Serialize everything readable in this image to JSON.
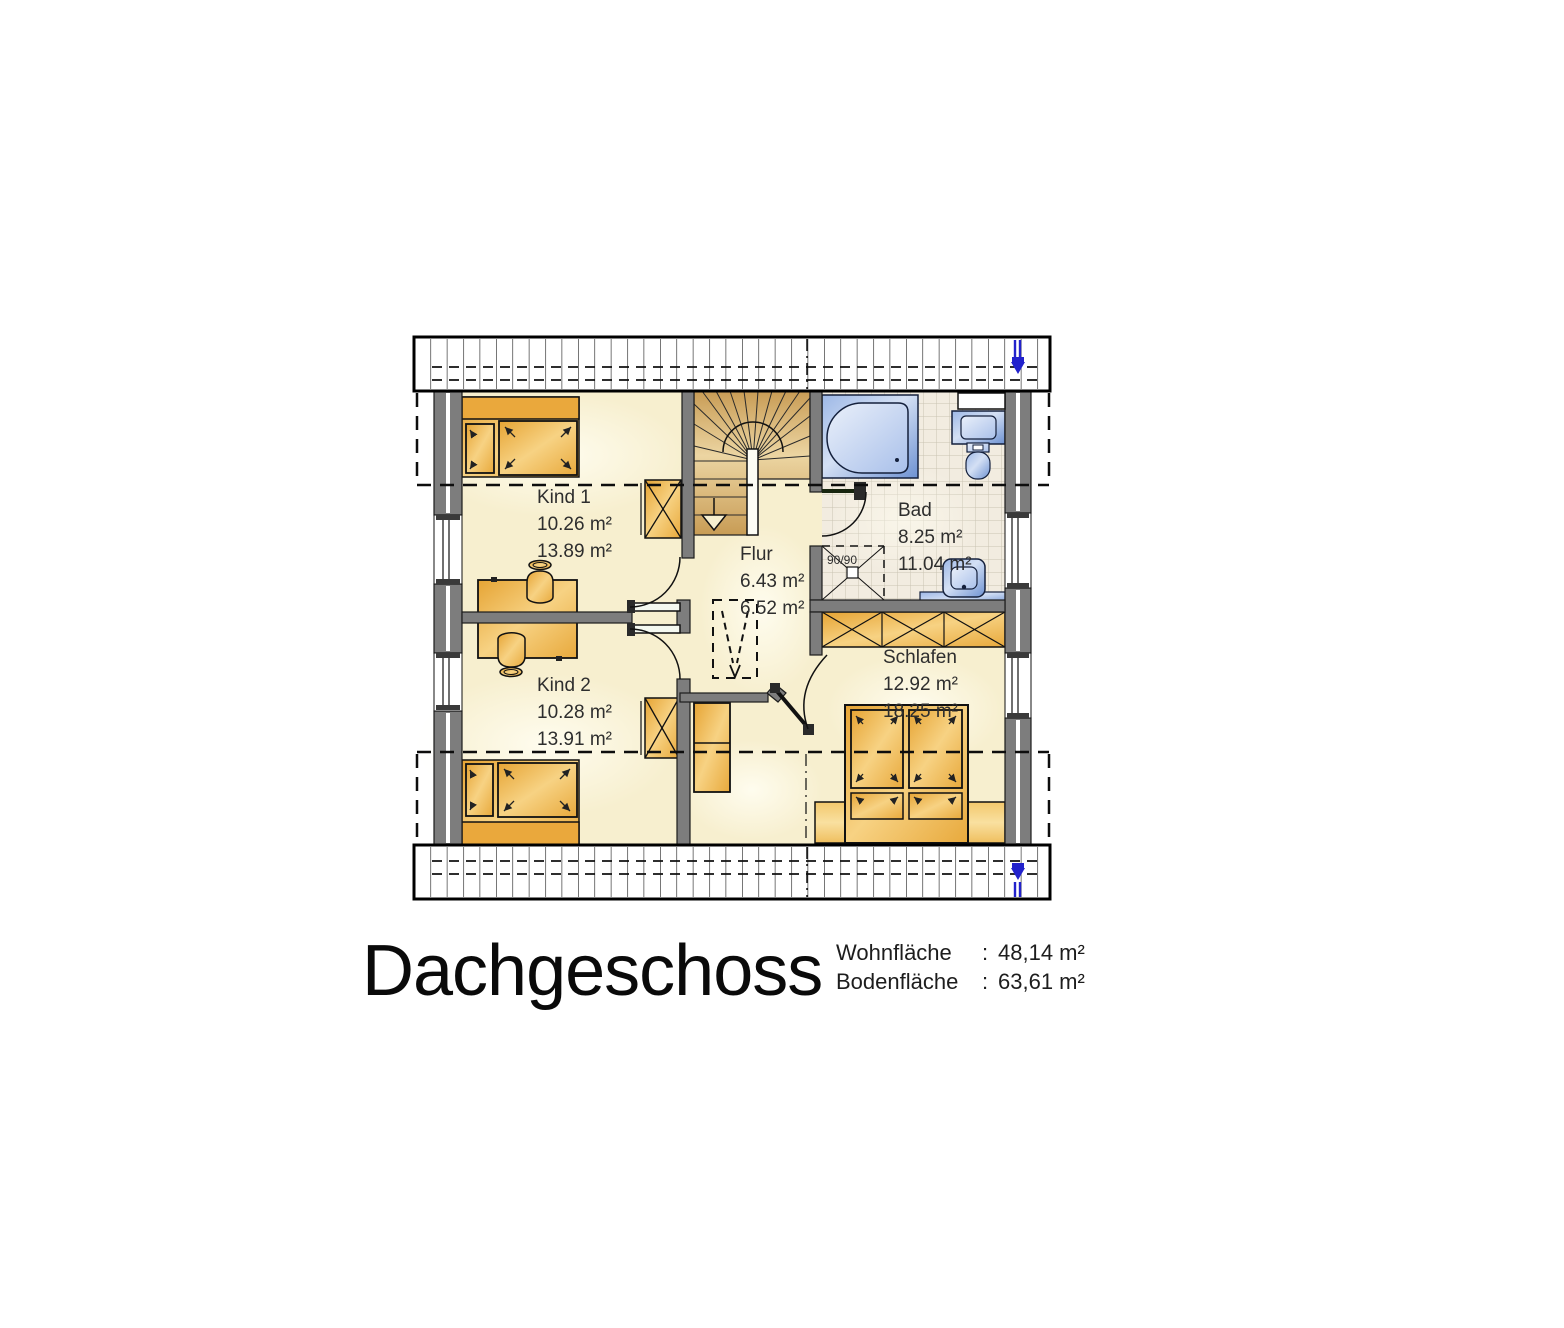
{
  "title": "Dachgeschoss",
  "stats": {
    "rows": [
      {
        "label": "Wohnfläche",
        "colon": ":",
        "value": "48,14 m²"
      },
      {
        "label": "Bodenfläche",
        "colon": ":",
        "value": "63,61 m²"
      }
    ]
  },
  "rooms": {
    "kind1": {
      "name": "Kind 1",
      "area_living": "10.26 m²",
      "area_floor": "13.89 m²"
    },
    "kind2": {
      "name": "Kind 2",
      "area_living": "10.28 m²",
      "area_floor": "13.91 m²"
    },
    "flur": {
      "name": "Flur",
      "area_living": "6.43 m²",
      "area_floor": "6.52 m²"
    },
    "bad": {
      "name": "Bad",
      "area_living": "8.25 m²",
      "area_floor": "11.04 m²"
    },
    "schlafen": {
      "name": "Schlafen",
      "area_living": "12.92 m²",
      "area_floor": "18.25 m²"
    }
  },
  "annotations": {
    "shower_size": "90/90"
  },
  "colors": {
    "wall": "#7d7d7d",
    "floor": "#f7efcf",
    "furniture_wood": "#eeb14a",
    "stair": "#d9b877",
    "bath_fixture": "#9db8e6",
    "tile_grid": "#c9c3b2",
    "roof_hatch": "#1a1a1a",
    "plumbing_symbol": "#2222cc"
  }
}
